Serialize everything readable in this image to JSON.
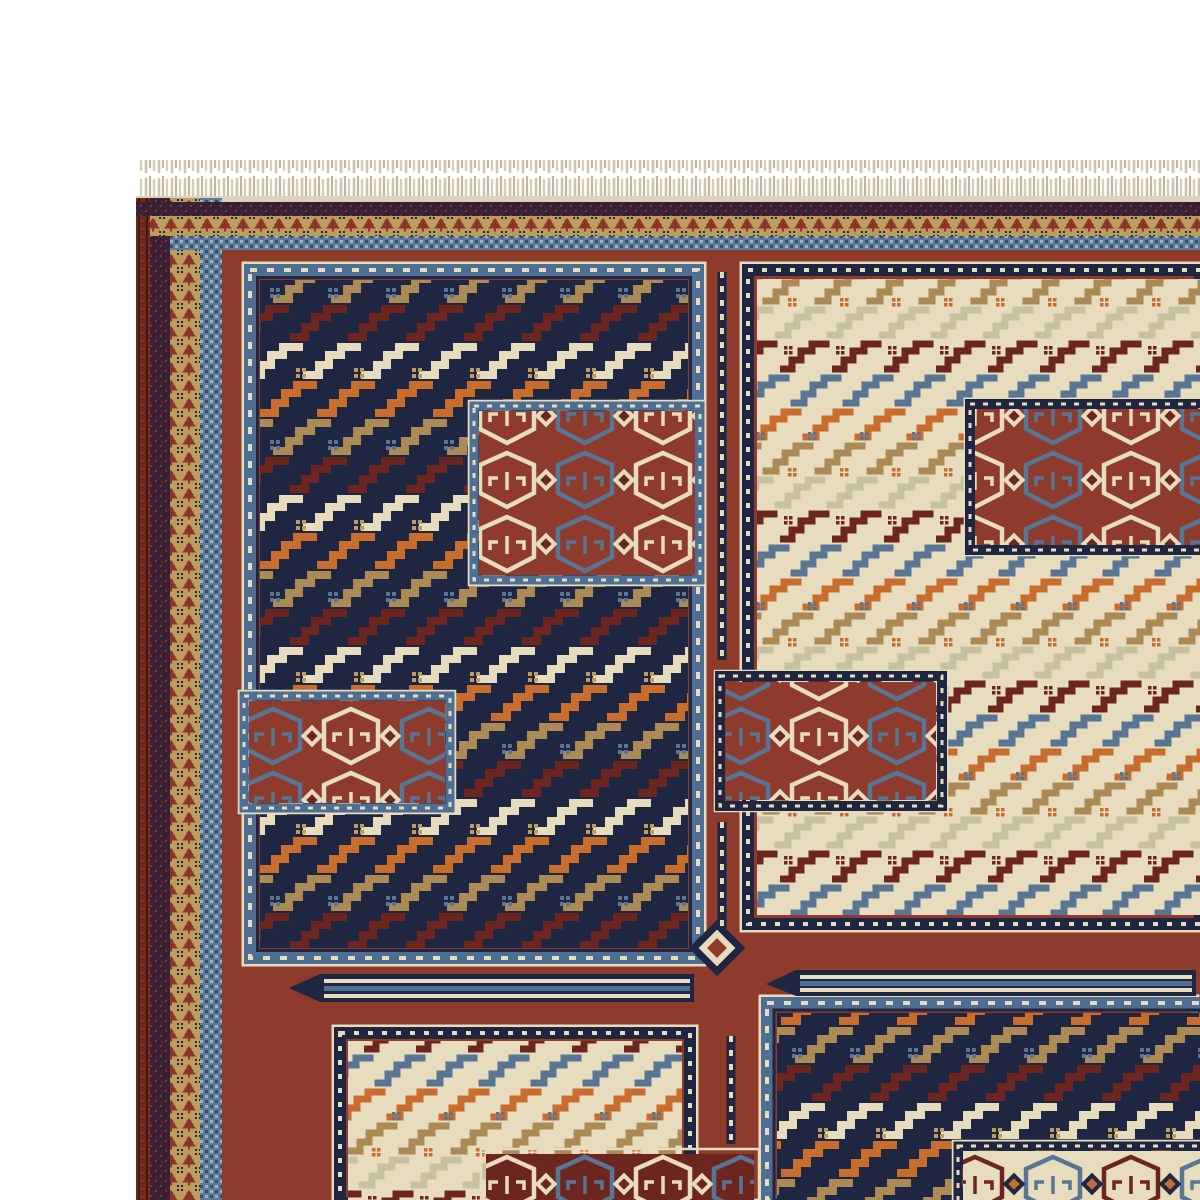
{
  "scene": {
    "type": "photograph",
    "subject": "top-left corner of a handwoven flat-weave (soumak kilim) oriental rug",
    "description": "Corner of a geometric Caucasian soumak rug on a plain white background. A cream knotted fringe runs along the top edge. Guard borders of checkered maroon-and-navy, a gold band with small red tree motifs and a slate-blue dotted band frame a brick-red field. The field holds large rectangular panels - dark navy and ivory - filled with diagonal rows of hooked zigzag (dragon) motifs in maroon, orange, cream, tan and steel blue, each panel edged with white-outlined Greek-key / sawtooth borders. Smaller inset boxes contain rows of hexagonal shield medallions with ram's-horn details; thin striped comb bars and a small stepped diamond ornament sit on the red ground between panels.",
    "background": "white"
  },
  "palette": {
    "white": "#ffffff",
    "fringe": "#cfc3aa",
    "fringeDark": "#c2b69c",
    "fringeLight": "#d8cdb6",
    "edgeCream": "#dcd2bd",
    "selvedge": "#70291f",
    "selvedgeDark": "#471713",
    "rust": "#8e3a2c",
    "maroon": "#6d2520",
    "redMotif": "#8c332b",
    "dkMaroon": "#4a1d28",
    "navy": "#1f2642",
    "blue": "#4d6f94",
    "steel": "#587693",
    "slate": "#5c7b97",
    "slateDark": "#33506e",
    "lightBlue": "#9db1c0",
    "cream": "#e8dcbe",
    "tan": "#ab8a55",
    "gold": "#bd9c5e",
    "orange": "#c96d2e",
    "sage": "#c6c2a0"
  },
  "parts": {
    "fringe": "knotted tassel fringe",
    "outer_guard": "checkered maroon/navy guard stripe",
    "gold_band": "gold band with red tree motifs",
    "blue_band": "slate-blue dotted band",
    "field": "brick-red field",
    "panel_navy_tl": "navy zigzag panel (top left)",
    "panel_cream_tr": "ivory zigzag panel (top right)",
    "panel_cream_bl": "ivory zigzag panel (bottom left)",
    "panel_navy_br": "navy zigzag panel (bottom right)",
    "medallion_boxes": "inset medallion boxes with shield motifs",
    "comb_bars": "striped comb bars on red ground",
    "diamond_ornament": "stepped diamond ornament"
  }
}
